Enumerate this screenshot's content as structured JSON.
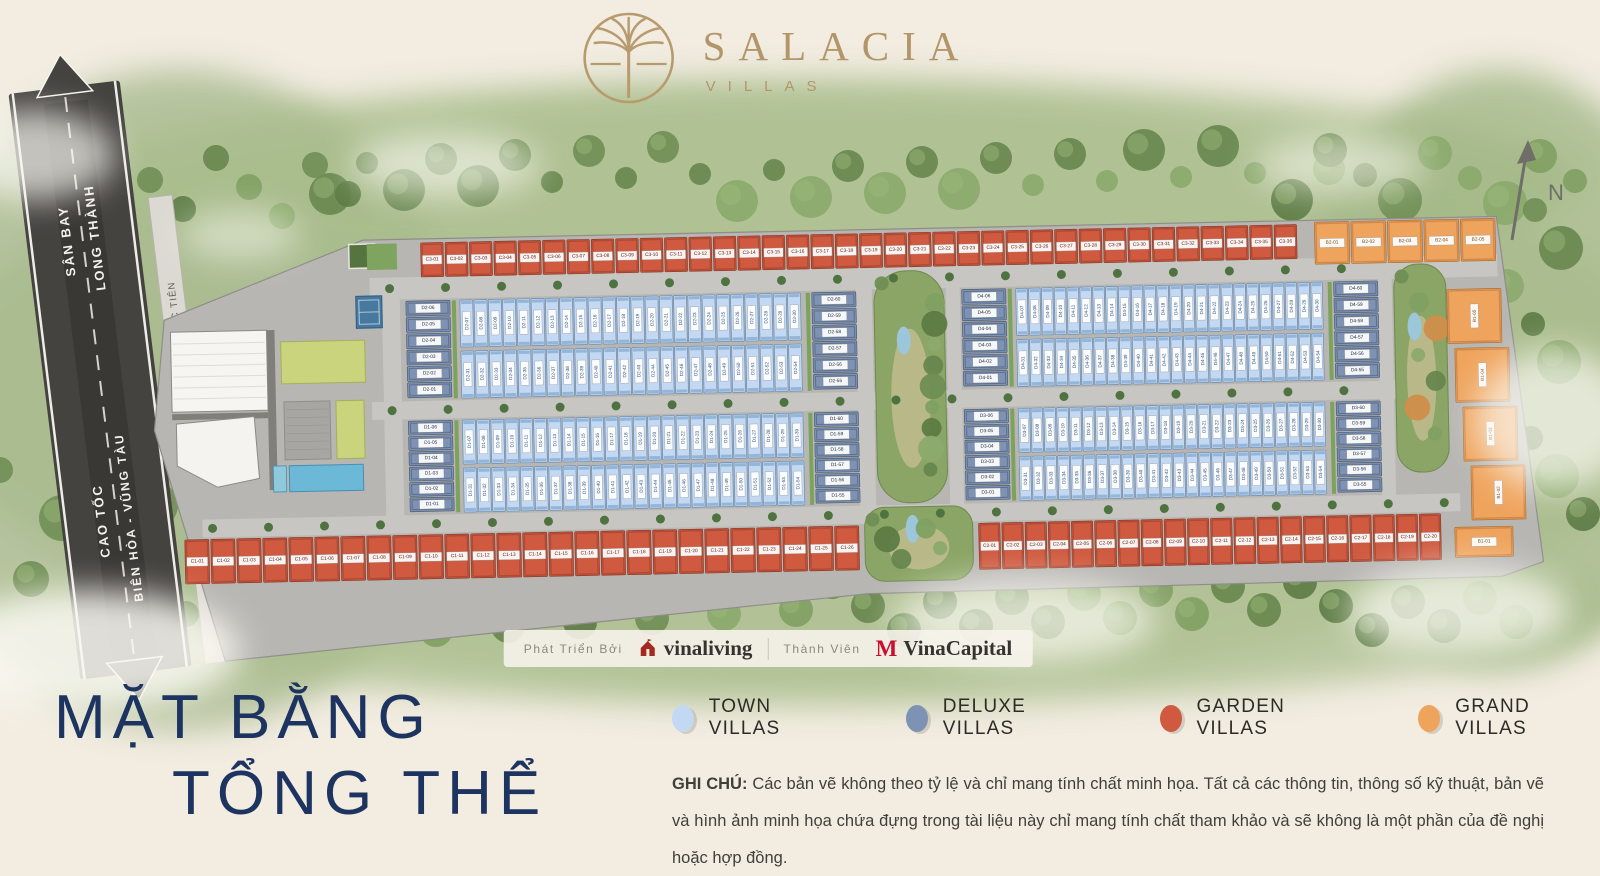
{
  "brand": {
    "name": "SALACIA",
    "tagline": "VILLAS",
    "gold": "#b2966a",
    "navy": "#1d3460"
  },
  "map": {
    "compass_label": "N",
    "roads": {
      "airport_destination": [
        "SÂN BAY",
        "LONG THÀNH"
      ],
      "highway": [
        "CAO TỐC",
        "BIÊN HÒA - VŨNG TÀU"
      ],
      "street": "ĐƯỜNG HẮC DỊCH - TÓC TIÊN"
    },
    "unit_groups": {
      "c3_row": {
        "prefix": "C3",
        "count": 36,
        "type": "garden"
      },
      "b2_row": {
        "prefix": "B2",
        "count": 5,
        "type": "grand"
      },
      "c1_row": {
        "prefix": "C1",
        "count": 26,
        "type": "garden"
      },
      "c2_row": {
        "prefix": "C2",
        "count": 20,
        "type": "garden"
      },
      "b1_column": {
        "prefix": "B1",
        "count": 5,
        "type": "grand"
      },
      "d_blocks": [
        {
          "prefix": "D2",
          "west": [
            1,
            6
          ],
          "north": [
            7,
            30
          ],
          "south": [
            31,
            54
          ],
          "east": [
            55,
            60
          ]
        },
        {
          "prefix": "D4",
          "west": [
            1,
            6
          ],
          "north": [
            7,
            30
          ],
          "south": [
            31,
            54
          ],
          "east": [
            55,
            60
          ]
        },
        {
          "prefix": "D1",
          "west": [
            1,
            6
          ],
          "north": [
            7,
            30
          ],
          "south": [
            31,
            54
          ],
          "east": [
            55,
            60
          ]
        },
        {
          "prefix": "D3",
          "west": [
            1,
            6
          ],
          "north": [
            7,
            30
          ],
          "south": [
            31,
            54
          ],
          "east": [
            55,
            60
          ]
        }
      ]
    },
    "plot_colors": {
      "town": "#c3d8f2",
      "deluxe": "#7e92b4",
      "garden": "#cf5a40",
      "grand": "#efa45d"
    }
  },
  "developer_bar": {
    "developed_by_label": "Phát Triển Bởi",
    "developer_name": "vinaliving",
    "member_label": "Thành Viên",
    "member_name": "VinaCapital"
  },
  "title": {
    "line1": "MẶT BẰNG",
    "line2": "TỔNG THỂ"
  },
  "legend": [
    {
      "label": "TOWN VILLAS",
      "type": "town"
    },
    {
      "label": "DELUXE VILLAS",
      "type": "deluxe"
    },
    {
      "label": "GARDEN VILLAS",
      "type": "garden"
    },
    {
      "label": "GRAND VILLAS",
      "type": "grand"
    }
  ],
  "note": {
    "prefix": "GHI CHÚ:",
    "text": "Các bản vẽ không theo tỷ lệ và chỉ mang tính chất minh họa. Tất cả các thông tin, thông số kỹ thuật, bản vẽ và hình ảnh minh họa chứa đựng trong tài liệu này chỉ mang tính chất tham khảo và sẽ không là một phần của đề nghị hoặc hợp đồng."
  }
}
